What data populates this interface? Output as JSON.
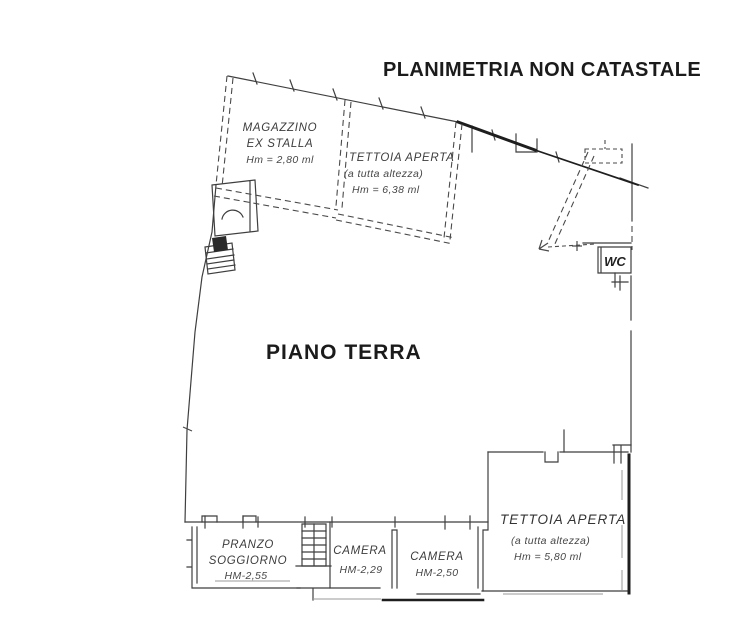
{
  "title": "PLANIMETRIA NON CATASTALE",
  "floor_label": "PIANO TERRA",
  "rooms": {
    "magazzino": {
      "line1": "MAGAZZINO",
      "line2": "EX STALLA",
      "height": "Hm = 2,80 ml"
    },
    "tettoia_top": {
      "name": "TETTOIA APERTA",
      "note": "(a tutta altezza)",
      "height": "Hm = 6,38 ml"
    },
    "wc": {
      "name": "WC"
    },
    "pranzo_soggiorno": {
      "line1": "PRANZO",
      "line2": "SOGGIORNO",
      "height": "HM-2,55"
    },
    "camera_1": {
      "name": "CAMERA",
      "height": "HM-2,29"
    },
    "camera_2": {
      "name": "CAMERA",
      "height": "HM-2,50"
    },
    "tettoia_bottom": {
      "name": "TETTOIA APERTA",
      "note": "(a tutta altezza)",
      "height": "Hm = 5,80 ml"
    }
  },
  "colors": {
    "ink": "#3f3f3f",
    "heavy": "#1e1e1e",
    "faint": "#999999",
    "background": "#ffffff"
  }
}
